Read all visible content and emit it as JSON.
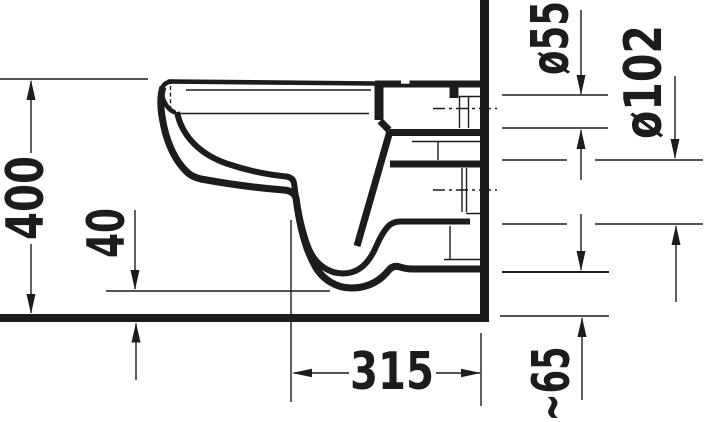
{
  "drawing": {
    "title": "Wall-hung toilet side-section technical drawing",
    "unit": "mm",
    "ink_color": "#1c1c1c",
    "background_color": "#ffffff",
    "dimensions": [
      {
        "id": "rim-height",
        "label": "400",
        "orientation": "vertical"
      },
      {
        "id": "front-underside-clearance",
        "label": "40",
        "orientation": "vertical"
      },
      {
        "id": "wall-to-trap-centre",
        "label": "315",
        "orientation": "horizontal"
      },
      {
        "id": "flush-inlet-diameter",
        "label": "ø55",
        "orientation": "vertical"
      },
      {
        "id": "outlet-diameter",
        "label": "ø102",
        "orientation": "vertical"
      },
      {
        "id": "underside-rear-gap",
        "label": "~65",
        "orientation": "vertical"
      }
    ]
  }
}
